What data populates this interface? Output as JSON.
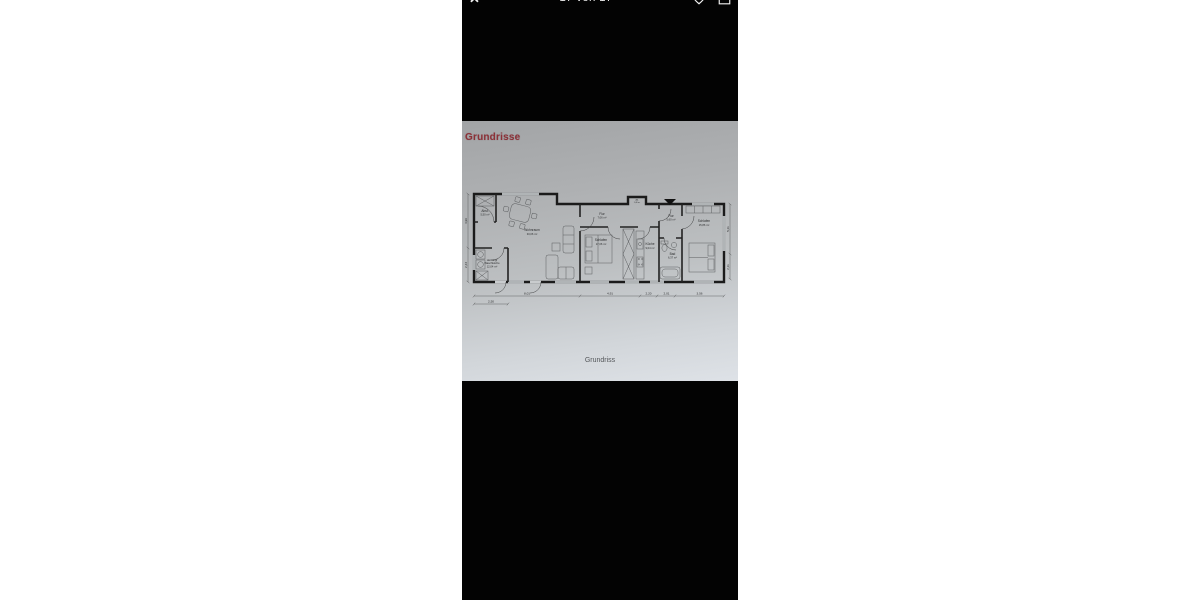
{
  "viewer": {
    "close_glyph": "✕",
    "page_indicator": "17 von 17",
    "icons": {
      "favorite": "heart-icon",
      "share": "share-icon"
    }
  },
  "document": {
    "title": "Grundrisse",
    "title_color": "#8c3138",
    "caption": "Grundriss"
  },
  "floorplan": {
    "rooms": {
      "abst": {
        "name": "Abst.",
        "area": "5,50 m²"
      },
      "wohnraum": {
        "name": "Wohnraum",
        "area": "33,06 m²"
      },
      "heizung": {
        "name": "Heizung/",
        "name2": "Waschküche",
        "area": "12,04 m²"
      },
      "flur_mid": {
        "name": "Flur",
        "area": "7,06 m²"
      },
      "ab_klein": {
        "name": "Ab.",
        "area": "1,40 m²"
      },
      "schlafen1": {
        "name": "Schlafen",
        "area": "17,06 m²"
      },
      "kueche": {
        "name": "Küche",
        "area": "9,04 m²"
      },
      "flur_r": {
        "name": "Flur",
        "area": "5,60 m²"
      },
      "bad": {
        "name": "Bad",
        "area": "6,37 m²"
      },
      "schlafen2": {
        "name": "Schlafen",
        "area": "15,86 m²"
      }
    },
    "dims_bottom": [
      "8,01",
      "4,91",
      "2,20",
      "2,01",
      "3,56"
    ],
    "dim_bottom2": "2,50",
    "dims_left": [
      "4,96",
      "2,43"
    ],
    "dims_right": [
      "5,11",
      "2,11"
    ]
  }
}
